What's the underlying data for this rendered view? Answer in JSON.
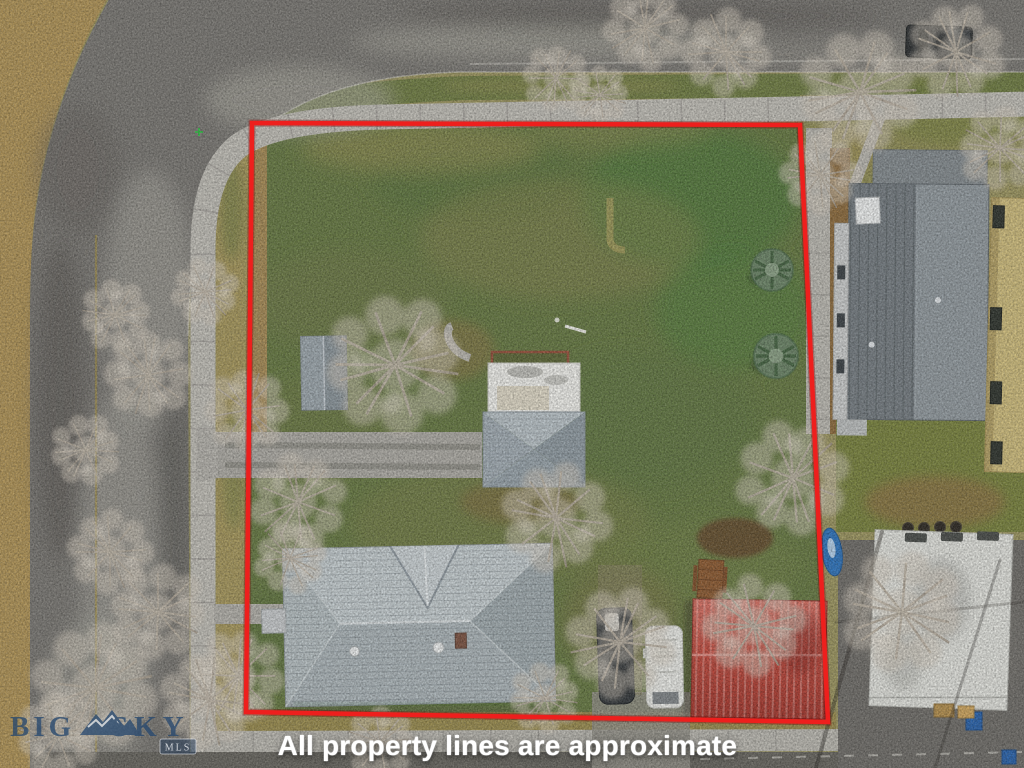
{
  "page": {
    "kind": "real-estate-aerial-drone-photo",
    "width": 1024,
    "height": 768
  },
  "overlay": {
    "caption": "All property lines are approximate",
    "caption_color": "#ffffff",
    "boundary": {
      "color": "#ee1f1d",
      "shadow_color": "rgba(120,0,0,0.35)",
      "points": "252,123 800,125 828,722 246,712"
    },
    "watermark": {
      "word_big": "BIG",
      "word_sky": "SKY",
      "badge": "MLS",
      "color": "#27486e",
      "icon": "mountain-peaks-icon"
    }
  },
  "scene": {
    "features": [
      "curved street on west and north with sidewalks",
      "large grass lot outlined in red",
      "main house with gray shingle roof",
      "secondary house with white flat roof and gray hip roof",
      "garden shed",
      "red metal roof garage",
      "dark SUV and white van parked",
      "neighbor house with two-tone gray roof",
      "tan apartment building at right edge",
      "white flat-roof garage bottom right",
      "two blue spruce evergreens",
      "many bare winter trees",
      "BIG SKY MLS watermark"
    ]
  }
}
